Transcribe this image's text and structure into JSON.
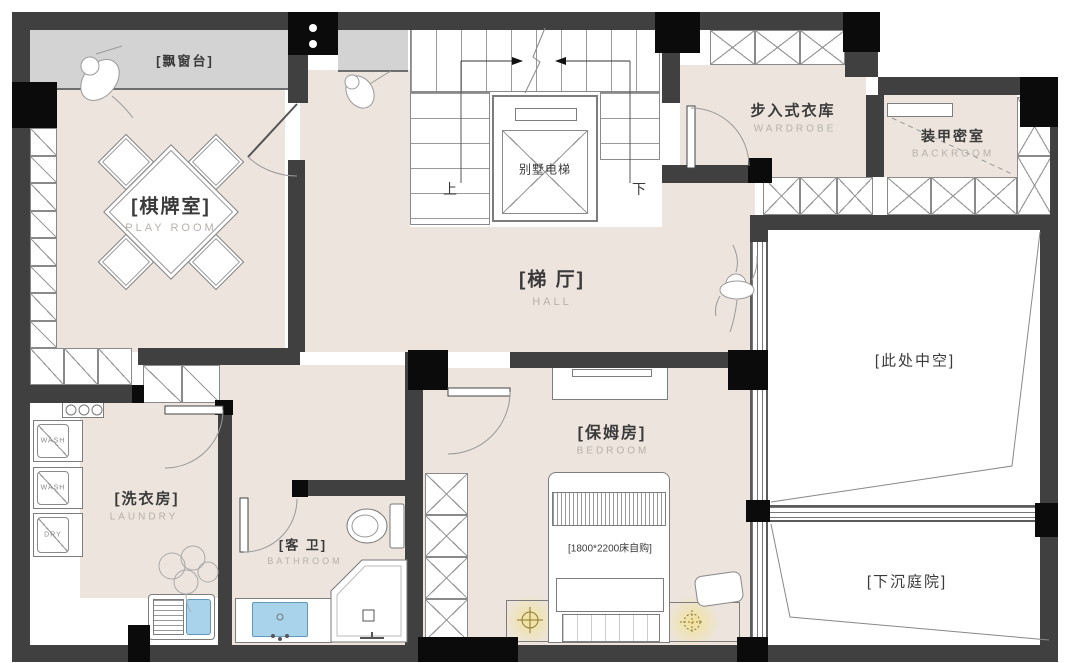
{
  "rooms": {
    "bay_window": {
      "name": "[飘窗台]"
    },
    "playroom": {
      "name": "[棋牌室]",
      "en": "PLAY ROOM"
    },
    "hall": {
      "name": "[梯 厅]",
      "en": "HALL"
    },
    "wardrobe": {
      "name": "步入式衣库",
      "en": "WARDROBE"
    },
    "backroom": {
      "name": "装甲密室",
      "en": "BACKROOM"
    },
    "void": {
      "name": "[此处中空]"
    },
    "courtyard": {
      "name": "[下沉庭院]"
    },
    "bedroom": {
      "name": "[保姆房]",
      "en": "BEDROOM"
    },
    "laundry": {
      "name": "[洗衣房]",
      "en": "LAUNDRY"
    },
    "bathroom": {
      "name": "[客 卫]",
      "en": "BATHROOM"
    }
  },
  "stairs": {
    "up_label": "上",
    "down_label": "下"
  },
  "elevator": {
    "label": "别墅电梯"
  },
  "bed": {
    "note": "[1800*2200床自购]"
  },
  "appliances": {
    "washer_top": "WASH",
    "washer_middle": "WASH",
    "dryer": "DRY"
  },
  "colors": {
    "floor": "#ECE4DD",
    "bay_window": "#D3D3D3",
    "wall": "#404040",
    "column": "#0B0B0B",
    "basin": "#A9D3EA",
    "lamp_glow": "#F3E7B9"
  }
}
